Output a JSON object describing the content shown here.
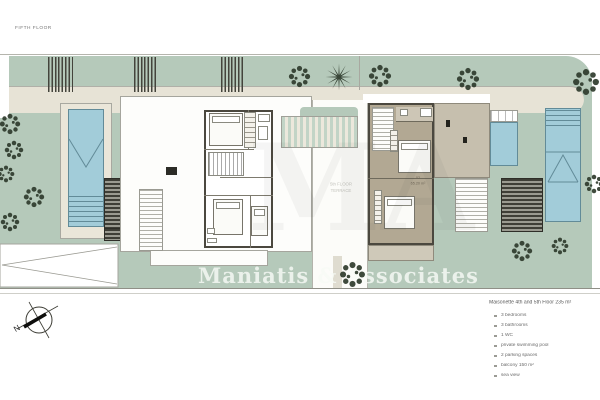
{
  "title": "FIFTH FLOOR",
  "watermark": "Maniatis & Associates",
  "ghost_watermark": "MA",
  "terrace": {
    "label_line1": "5th FLOOR",
    "label_line2": "TERRACE"
  },
  "unit": {
    "number": "02",
    "area": "65.20 m²"
  },
  "compass": {
    "north": "N"
  },
  "legend": {
    "heading": "Maisonette 4th and 5th Floor 235 m²",
    "items": [
      "3 bedrooms",
      "3 bathrooms",
      "1 WC",
      "private swimming pool",
      "2 parking spaces",
      "balcony 150 m²",
      "sea view"
    ]
  },
  "colors": {
    "lawn_green": "#b5c9ba",
    "path_beige": "#e7e3d6",
    "unit_floor_taupe": "#b2a893",
    "pool_blue": "#a2ccd9",
    "louver_dark": "#3c3c34",
    "tree_green": "#2f3b2d"
  }
}
